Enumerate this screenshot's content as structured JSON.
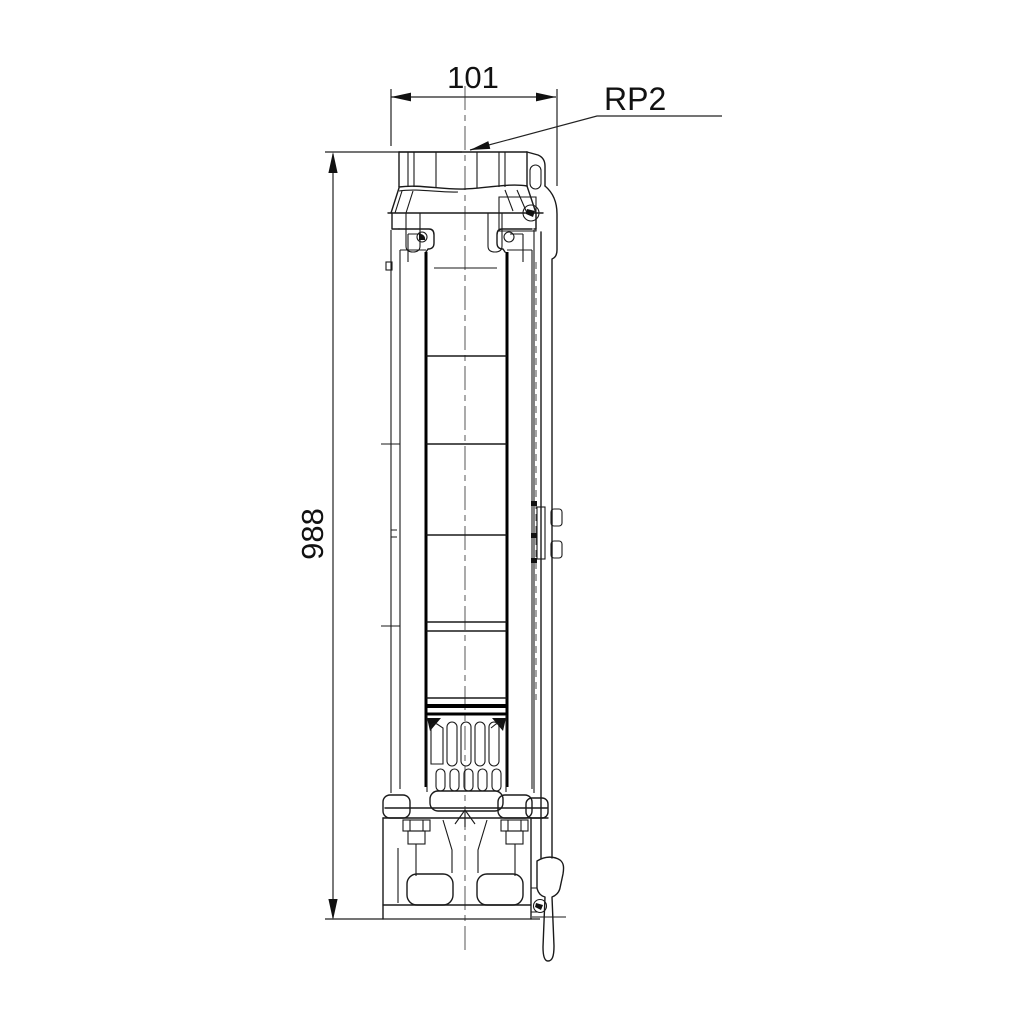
{
  "document": {
    "type": "technical dimensional drawing",
    "subject": "submersible borehole pump, side elevation",
    "background_color": "#ffffff",
    "line_color": "#1a1a1a"
  },
  "dimensions": {
    "width": {
      "value": "101",
      "orientation": "horizontal",
      "position": "top"
    },
    "height": {
      "value": "988",
      "orientation": "vertical",
      "position": "left"
    }
  },
  "labels": {
    "connection": "RP2"
  }
}
